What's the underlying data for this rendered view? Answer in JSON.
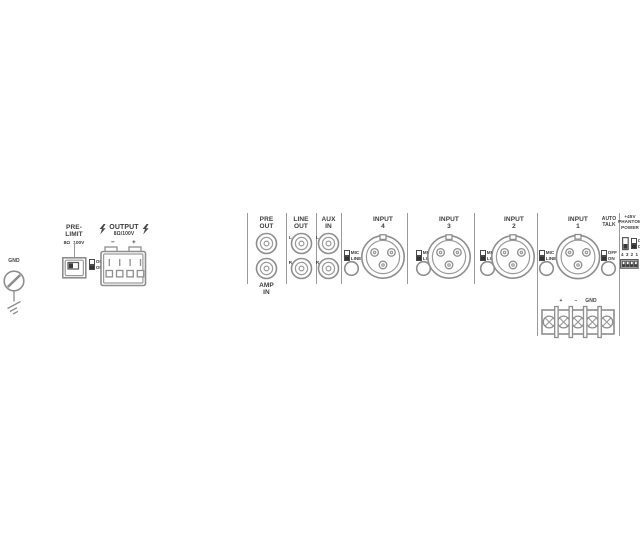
{
  "colors": {
    "line": "#9a9a9a",
    "text": "#3d3d3d"
  },
  "gnd": {
    "label": "GND"
  },
  "pre_limit": {
    "title_line1": "PRE-",
    "title_line2": "LIMIT",
    "imp_left": "8Ω",
    "imp_right": "100V",
    "off": "OFF",
    "on": "ON"
  },
  "output": {
    "title": "OUTPUT",
    "impedance": "8Ω/100V",
    "minus": "−",
    "plus": "+"
  },
  "rca": {
    "pre_out": {
      "line1": "PRE",
      "line2": "OUT"
    },
    "amp_in": {
      "line1": "AMP",
      "line2": "IN"
    },
    "line_out": {
      "line1": "LINE",
      "line2": "OUT",
      "left": "L",
      "right": "R"
    },
    "aux_in": {
      "line1": "AUX",
      "line2": "IN",
      "left": "L",
      "right": "R"
    }
  },
  "inputs": [
    {
      "label": "INPUT",
      "number": "4",
      "mic": "MIC",
      "line": "LINE"
    },
    {
      "label": "INPUT",
      "number": "3",
      "mic": "MIC",
      "line": "LINE"
    },
    {
      "label": "INPUT",
      "number": "2",
      "mic": "MIC",
      "line": "LINE"
    },
    {
      "label": "INPUT",
      "number": "1",
      "mic": "MIC",
      "line": "LINE"
    }
  ],
  "auto_talk": {
    "line1": "AUTO",
    "line2": "TALK",
    "off": "OFF",
    "on": "ON"
  },
  "phantom": {
    "line1": "+45V",
    "line2": "PHANTOM",
    "line3": "POWER",
    "off": "OFF",
    "on": "ON",
    "dip_4": "4",
    "dip_3": "3",
    "dip_2": "2",
    "dip_1": "1"
  },
  "terminal": {
    "plus": "+",
    "minus": "−",
    "gnd": "GND"
  }
}
